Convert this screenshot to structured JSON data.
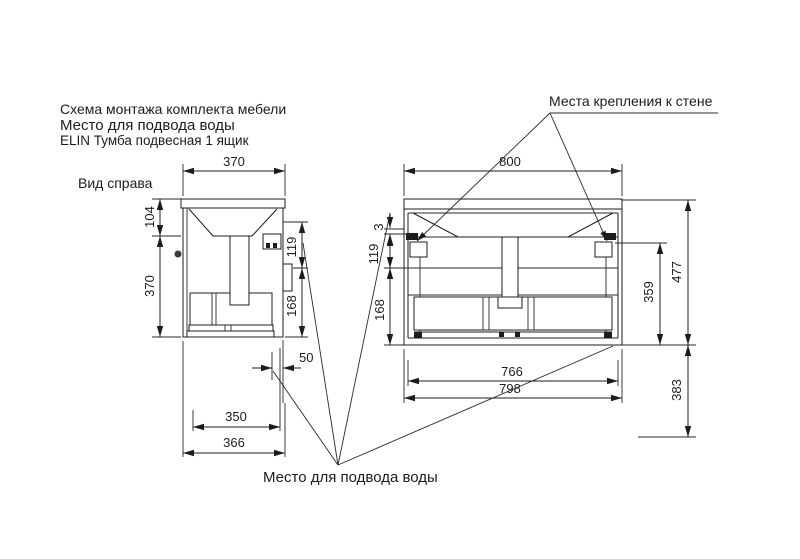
{
  "header": {
    "line1": "Схема монтажа комплекта мебели",
    "line2": "Место для подвода воды",
    "line3": "ELIN Тумба подвесная 1 ящик"
  },
  "callouts": {
    "wall_mount": "Места крепления к стене",
    "water_supply": "Место для подвода воды"
  },
  "side_view": {
    "label": "Вид справа",
    "dims": {
      "top_width": "370",
      "left_upper": "104",
      "left_lower": "370",
      "right_upper": "119",
      "right_lower": "168",
      "water_offset": "50",
      "bottom_inner": "350",
      "bottom_outer": "366"
    }
  },
  "front_view": {
    "dims": {
      "top_width": "800",
      "left_gap": "3",
      "left_upper": "119",
      "left_lower": "168",
      "inner_height": "359",
      "total_height": "477",
      "floor_clearance": "383",
      "bottom_inner": "766",
      "bottom_outer": "798"
    }
  }
}
